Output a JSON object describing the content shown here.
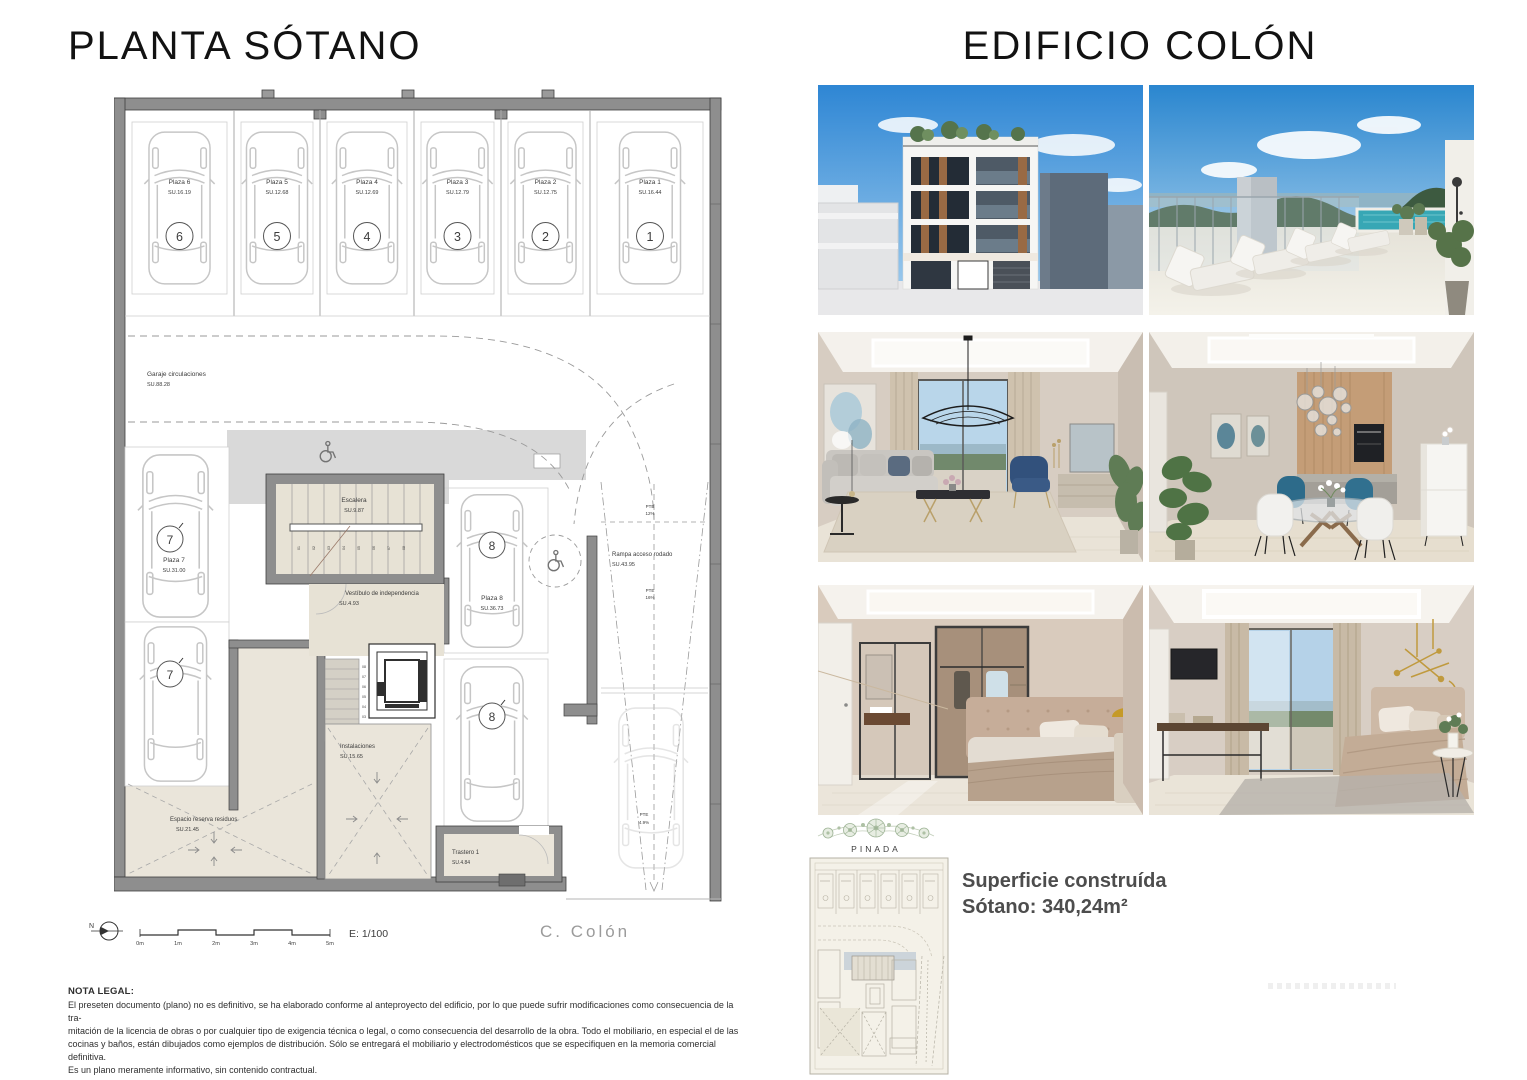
{
  "titles": {
    "left": "PLANTA SÓTANO",
    "right": "EDIFICIO COLÓN"
  },
  "plan": {
    "parking_top": [
      {
        "name": "Plaza 6",
        "area": "SU.16.19",
        "num": "6"
      },
      {
        "name": "Plaza 5",
        "area": "SU.12.68",
        "num": "5"
      },
      {
        "name": "Plaza 4",
        "area": "SU.12.69",
        "num": "4"
      },
      {
        "name": "Plaza 3",
        "area": "SU.12.79",
        "num": "3"
      },
      {
        "name": "Plaza 2",
        "area": "SU.12.75",
        "num": "2"
      },
      {
        "name": "Plaza 1",
        "area": "SU.16.44",
        "num": "1"
      }
    ],
    "garaje": {
      "name": "Garaje circulaciones",
      "area": "SU.88.28"
    },
    "plaza7": {
      "name": "Plaza 7",
      "area": "SU.31.00",
      "num": "7"
    },
    "plaza8": {
      "name": "Plaza 8",
      "area": "SU.36.73",
      "num": "8"
    },
    "escalera": {
      "name": "Escalera",
      "area": "SU.9.87"
    },
    "vestibulo": {
      "name": "Vestíbulo de independencia",
      "area": "SU.4.93"
    },
    "instalaciones": {
      "name": "Instalaciones",
      "area": "SU.15.65"
    },
    "residuos": {
      "name": "Espacio reserva residuos",
      "area": "SU.21.45"
    },
    "trastero": {
      "name": "Trastero 1",
      "area": "SU.4.84"
    },
    "rampa": {
      "name": "Rampa acceso rodado",
      "area": "SU.43.95"
    },
    "pte_12": {
      "label": "PTE",
      "value": "12%"
    },
    "pte_16": {
      "label": "PTE",
      "value": "16%"
    },
    "pte_49": {
      "label": "PTE",
      "value": "4.9%"
    },
    "stair_treads": [
      "01",
      "02",
      "03",
      "04",
      "05",
      "06",
      "07",
      "08"
    ],
    "north": "N",
    "scale_ticks": [
      "0m",
      "1m",
      "2m",
      "3m",
      "4m",
      "5m"
    ],
    "scale_ratio": "E: 1/100",
    "street": "C. Colón"
  },
  "legal": {
    "title": "NOTA LEGAL:",
    "lines": [
      "El preseten documento (plano) no es definitivo, se ha elaborado conforme al anteproyecto del edificio, por lo que puede sufrir modificaciones como consecuencia de la tra-",
      "mitación de la licencia de obras o por cualquier tipo de exigencia técnica o legal, o como consecuencia del desarrollo de la obra. Todo el mobiliario, en especial el de las",
      "cocinas y baños, están dibujados como ejemplos de distribución. Sólo se entregará el mobiliario y electrodomésticos que se especifiquen en la memoria comercial definitiva.",
      "Es un plano meramente informativo, sin contenido contractual."
    ]
  },
  "brand": {
    "logo": "PINADA"
  },
  "summary": {
    "line1": "Superficie construída",
    "line2": "Sótano: 340,24m²"
  },
  "photos": [
    "building-exterior-render",
    "rooftop-pool-render",
    "living-room-render",
    "dining-kitchen-render",
    "bedroom-wardrobe-render",
    "bedroom-view-render"
  ],
  "colors": {
    "wall_gray": "#8e8e8e",
    "room_beige": "#eae5da",
    "slab_gray": "#d9d9d9",
    "sky_blue": "#3f97df",
    "pool_teal": "#2e9fb0",
    "brand_green": "#8ba183",
    "text_dark": "#2f2f2f"
  }
}
